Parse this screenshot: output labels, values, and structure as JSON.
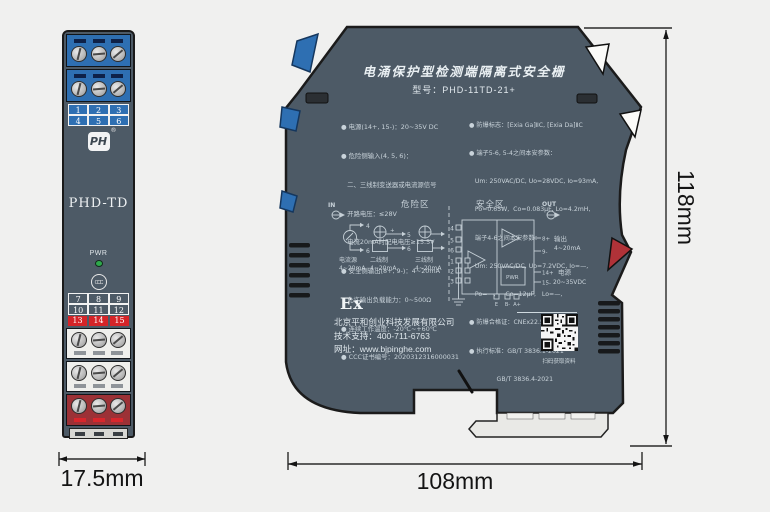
{
  "front_view": {
    "model_label": "PHD-TD",
    "logo_text": "PH",
    "logo_reg": "®",
    "pwr_label": "PWR",
    "ccc_label": "CCC",
    "terminals_top": [
      "1",
      "2",
      "3",
      "4",
      "5",
      "6"
    ],
    "terminals_mid": [
      "7",
      "8",
      "9",
      "10",
      "11",
      "12"
    ],
    "terminals_red": [
      "13",
      "14",
      "15"
    ]
  },
  "side_view": {
    "title": "电涌保护型检测端隔离式安全栅",
    "model_line": "型号：PHD-11TD-21+",
    "specs_left": [
      "● 电源(14+, 15-)：20~35V DC",
      "● 危险侧输入(4, 5, 6)：",
      "   二、三线制变送器或电流源信号",
      "   开路电压：≤28V",
      "   电流20mA时配电电压≥15.5V",
      "● 安全侧输出(8+, 9-)：4~20mA",
      "   允许输出负载能力：0~500Ω",
      "● 连续工作温度：-20℃~+60℃",
      "● CCC证书编号：2020312316000031"
    ],
    "specs_right": [
      "● 防爆标志：[Exia Ga]ⅡC, [Exia Da]ⅡC",
      "● 端子5-6, 5-4之间本安参数：",
      "   Um: 250VAC/DC, Uo=28VDC, Io=93mA,",
      "   Po=0.65W,  Co=0.083μF, Lo=4.2mH,",
      "   端子4-6之间本安参数：",
      "   Um: 250VAC/DC, Uo=7.2VDC, Io=—,",
      "   Po=—,     Co=12μF,   Lo=—,",
      "● 防爆合格证：CNEx22.5866",
      "● 执行标准：GB/T 3836.1-2021",
      "              GB/T 3836.4-2021"
    ],
    "circuit": {
      "hazard_zone": "危险区",
      "safe_zone": "安全区",
      "in": "IN",
      "out": "OUT",
      "src1_name": "电流源",
      "src1_range": "4~20mA",
      "src2_name": "二线制",
      "src2_range": "4~20mA",
      "src3_name": "三线制",
      "src3_range": "4~20mA",
      "plus": "+",
      "minus": "-",
      "t1": "1",
      "t2": "2",
      "t3": "3",
      "t4": "4",
      "t5": "5",
      "t6": "6",
      "t8": "8+",
      "t9": "9-",
      "t14": "14+",
      "t15": "15-",
      "out_name": "输出",
      "out_range": "4~20mA",
      "pwr_box": "PWR",
      "pwr_name": "电源",
      "pwr_range": "20~35VDC",
      "tE": "E",
      "tB": "B-",
      "tA": "A+"
    },
    "ex_mark": "Ex",
    "company": "北京平和创业科技发展有限公司",
    "support": "技术支持：400-711-6763",
    "website": "网址：www.bjpinghe.com",
    "qr_caption": "扫码获取资料"
  },
  "dimensions": {
    "front_width": "17.5mm",
    "side_width": "108mm",
    "height": "118mm"
  },
  "colors": {
    "background": "#f0f0ef",
    "body": "#4d5a66",
    "terminal_blue": "#2e6fb2",
    "terminal_red": "#9c3136",
    "red_strip": "#d42428",
    "red_clip": "#b03238",
    "pwr_led": "#2ea84b",
    "outline": "#1a1a1a",
    "print_text": "#cfd9df"
  }
}
